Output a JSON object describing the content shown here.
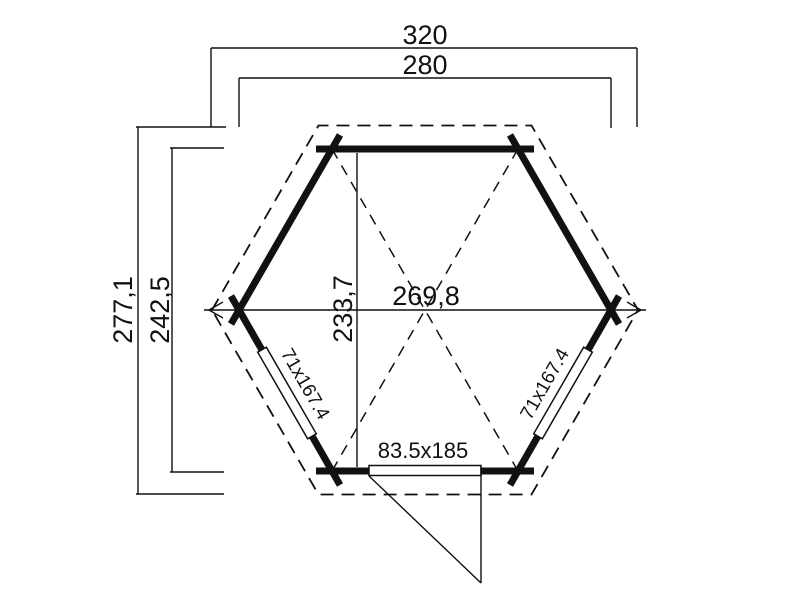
{
  "drawing": {
    "type": "hexagonal-gazebo-floor-plan",
    "dimensions": {
      "roof_width": "320",
      "wall_width": "280",
      "roof_depth": "277,1",
      "wall_depth": "242,5",
      "inner_width": "269,8",
      "inner_depth": "233,7"
    },
    "openings": {
      "window_left": "71x167.4",
      "window_right": "71x167.4",
      "door": "83.5x185"
    },
    "colors": {
      "line": "#111111",
      "background": "#ffffff"
    }
  }
}
